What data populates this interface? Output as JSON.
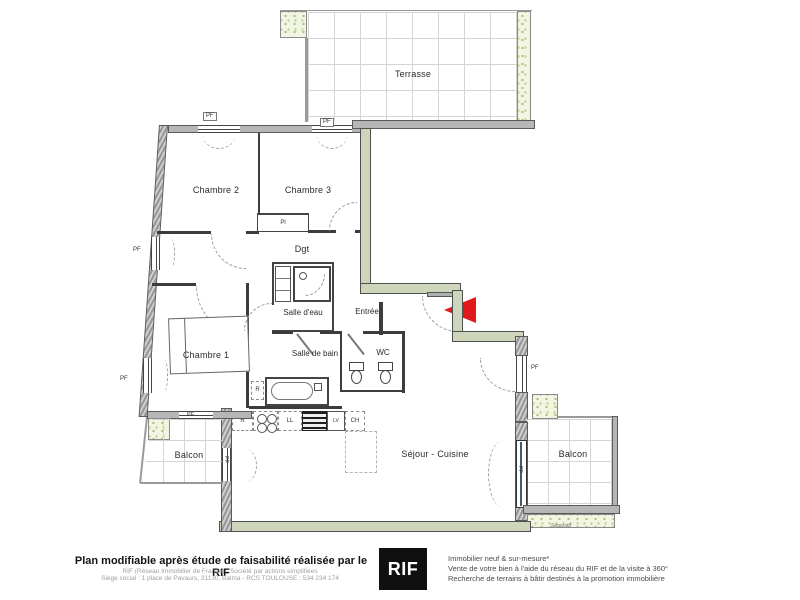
{
  "rooms": {
    "terrasse": "Terrasse",
    "chambre2": "Chambre 2",
    "chambre3": "Chambre 3",
    "dgt": "Dgt",
    "salle_deau": "Salle d'eau",
    "entree": "Entrée",
    "chambre1": "Chambre 1",
    "salle_de_bain": "Salle de bain",
    "wc": "WC",
    "sejour_cuisine": "Séjour - Cuisine",
    "balcon_left": "Balcon",
    "balcon_right": "Balcon"
  },
  "tags": {
    "window": "PF",
    "closet": "Pl",
    "fridge": "R",
    "washer": "LL",
    "dishwasher": "LV",
    "boiler": "CH",
    "separator": "Séparatif"
  },
  "footer": {
    "left": {
      "headline": "Plan modifiable après étude de faisabilité réalisée par le RIF",
      "line1": "RIF (Réseau Immobilier de France) - Société par actions simplifiées",
      "line2": "Siège social : 1 place de Pavaurs, 31130, Balma - RCS TOULOUSE : 534 234 174"
    },
    "logo": "RIF",
    "right": {
      "line1": "Immobilier neuf & sur-mesure*",
      "line2": "Vente de votre bien à l'aide du réseau du RIF et de la visite à 360°",
      "line3": "Recherche de terrains à bâtir destinés à la promotion immobilière"
    }
  },
  "colors": {
    "wall_green": "#cdd6ba",
    "wall_gray": "#b6b6b6",
    "arrow_red": "#e01a1c",
    "planter_green": "#f1f5e2"
  }
}
